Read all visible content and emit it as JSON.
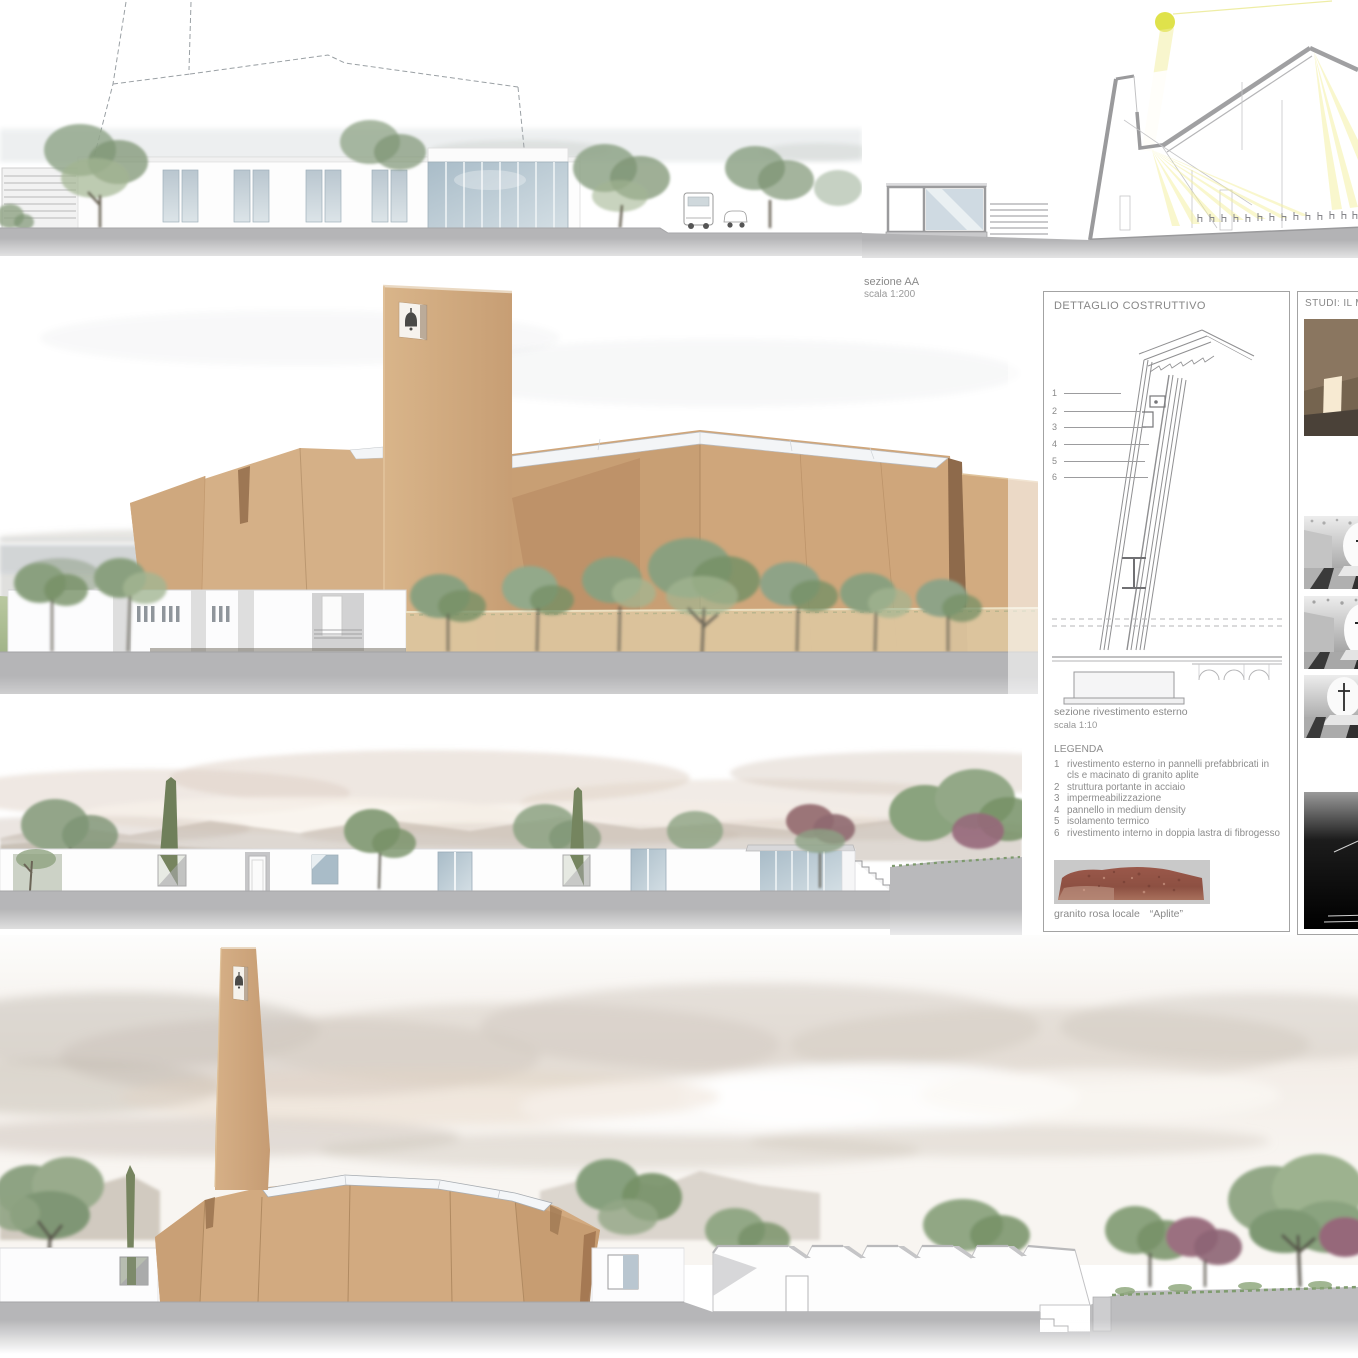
{
  "page": {
    "background": "#ffffff"
  },
  "section_label": {
    "line1": "sezione AA",
    "line2": "scala 1:200"
  },
  "detail_panel": {
    "title": "DETTAGLIO COSTRUTTIVO",
    "callouts": [
      "1",
      "2",
      "3",
      "4",
      "5",
      "6"
    ],
    "caption_line1": "sezione rivestimento esterno",
    "caption_line2": "scala 1:10",
    "legend_title": "LEGENDA",
    "legend_items": [
      {
        "num": "1",
        "text": "rivestimento esterno in pannelli prefabbricati in cls e macinato di granito aplite"
      },
      {
        "num": "2",
        "text": "struttura portante in acciaio"
      },
      {
        "num": "3",
        "text": "impermeabilizzazione"
      },
      {
        "num": "4",
        "text": "pannello in medium density"
      },
      {
        "num": "5",
        "text": "isolamento termico"
      },
      {
        "num": "6",
        "text": "rivestimento interno in doppia lastra di fibrogesso"
      }
    ],
    "material_caption_name": "granito rosa locale",
    "material_caption_quote": "“Aplite”"
  },
  "studies_panel": {
    "title": "STUDI: IL MO"
  },
  "colors": {
    "facade_tan": "#d2a87d",
    "facade_tan_light": "#dbb68c",
    "facade_tan_dark": "#c0966d",
    "facade_slot_shadow": "#9a734f",
    "skylight_white": "#f3f5f7",
    "sun_yellow": "#dfe24b",
    "light_ray_yellow": "#f3ef9d",
    "glass_blue": "#aebfca",
    "ground_gray": "#b5b5b7",
    "tree_green": "#8aa07f",
    "tree_green_dark": "#769066",
    "cypress_green": "#76845f",
    "tree_purple": "#9b7080",
    "granite_red": "#9a584a",
    "mountain_taupe": "#b0a496",
    "text_gray": "#8a8a8a",
    "panel_border": "#a3a3a3",
    "section_poche_gray": "#9a9a9c"
  }
}
